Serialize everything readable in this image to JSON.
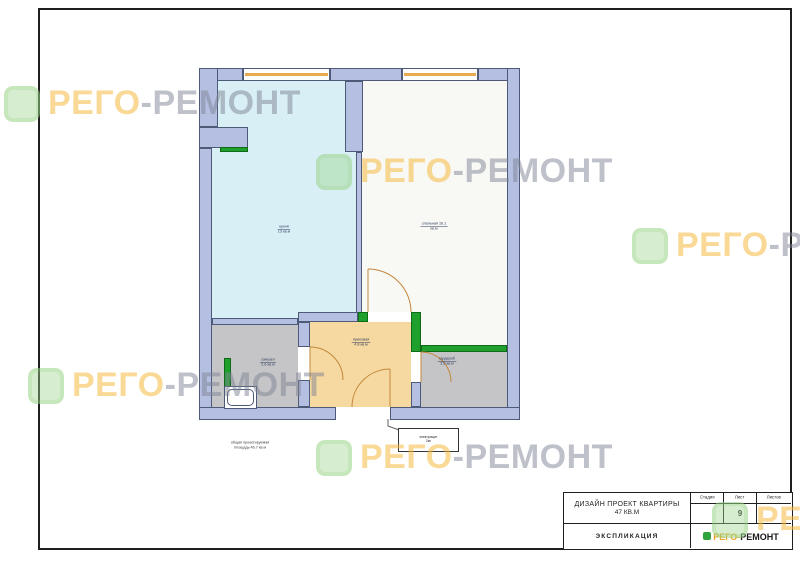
{
  "watermark": {
    "brand_orange": "РЕГО",
    "brand_gray": "-РЕМОНТ",
    "color_orange": "#f6ba42",
    "color_gray": "#7d8494",
    "icon_color": "#9ed68c"
  },
  "plan": {
    "rooms": [
      {
        "id": "kitchen",
        "label": "кухня",
        "area": "13 кв.м",
        "floor_color": "#d8eff5"
      },
      {
        "id": "bedroom",
        "label": "спальная 16.1",
        "area": "кв.м",
        "floor_color": "#f8f8f4"
      },
      {
        "id": "hallway",
        "label": "прихожая",
        "area": "4.8 кв.м",
        "floor_color": "#f6d9a0"
      },
      {
        "id": "bathroom",
        "label": "санузел",
        "area": "2.6 кв.м",
        "floor_color": "#c5c5c7"
      },
      {
        "id": "wardrobe",
        "label": "гардероб",
        "area": "3.5 кв.м",
        "floor_color": "#c5c5c7"
      }
    ],
    "note_line1": "общая проектируемая",
    "note_line2": "площадь 46.7 кв.м",
    "utility_line1": "электрощит",
    "utility_line2": "2м²",
    "wall_color": "#b5bfe2",
    "new_wall_color": "#1fa02c",
    "window_color": "#e9a94e"
  },
  "title_block": {
    "project_line1": "ДИЗАЙН ПРОЕКТ КВАРТИРЫ",
    "project_line2": "47 КВ.М",
    "col_stage_label": "Стадия",
    "col_sheet_label": "Лист",
    "col_sheets_label": "Листов",
    "stage_value": "",
    "sheet_value": "9",
    "sheets_value": "",
    "doc_type": "ЭКСПЛИКАЦИЯ",
    "logo_orange": "РЕГО-",
    "logo_dark": "РЕМОНТ"
  }
}
